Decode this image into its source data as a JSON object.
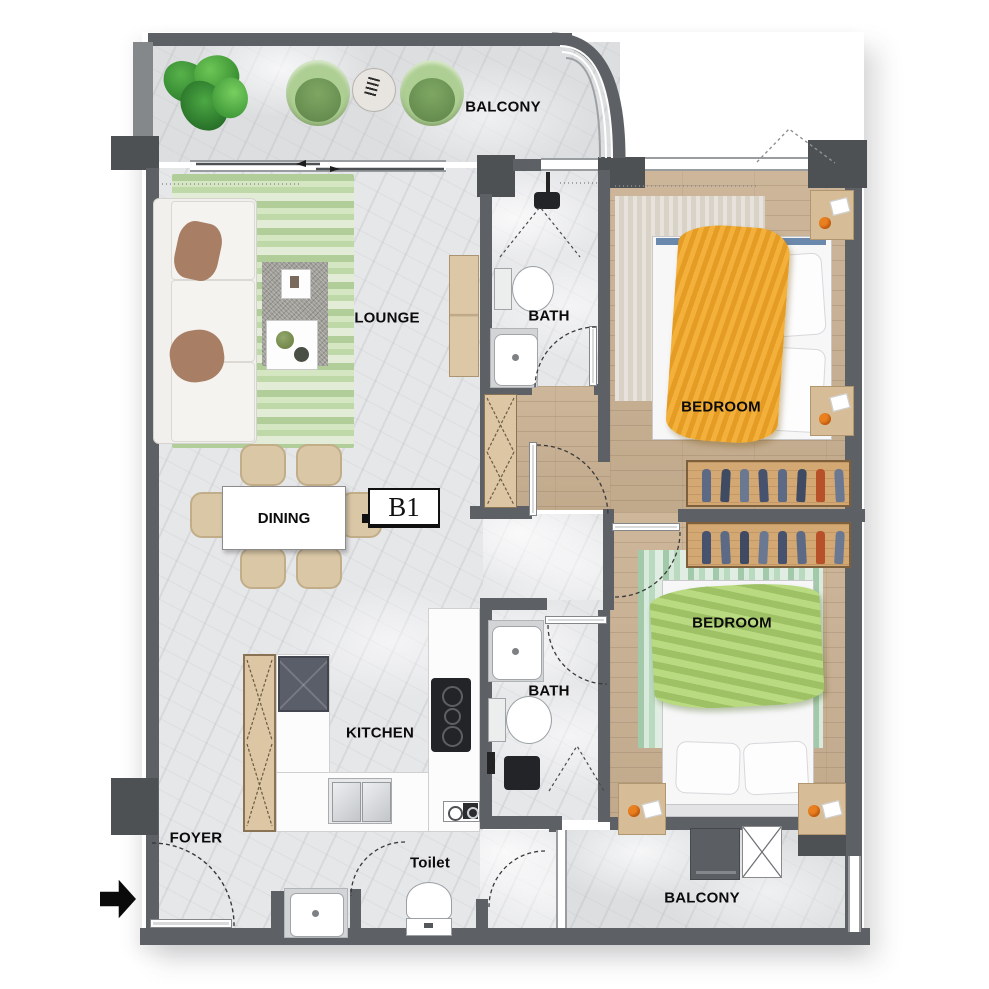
{
  "unit": {
    "label": "B1"
  },
  "rooms": {
    "balcony_top": "BALCONY",
    "lounge": "LOUNGE",
    "bath_top": "BATH",
    "bedroom_top": "BEDROOM",
    "dining": "DINING",
    "kitchen": "KITCHEN",
    "bath_mid": "BATH",
    "bedroom_bottom": "BEDROOM",
    "foyer": "FOYER",
    "toilet": "Toilet",
    "balcony_bottom": "BALCONY"
  },
  "colors": {
    "wall": "#5d6165",
    "column": "#4d5154",
    "marble_floor": "#e6e7e9",
    "wood_floor": "#c8b094",
    "rug_green": "#cfe0bd",
    "rug_beige": "#d8d2c7",
    "blanket_yellow": "#f0ae38",
    "blanket_green": "#b9da80",
    "wardrobe_wood": "#d3a873",
    "accent_orange": "#ea7f1f",
    "counter_white": "#fcfcfc",
    "appliance_dark": "#5b5f64"
  },
  "icons": {
    "entry_arrow": "right-arrow"
  }
}
